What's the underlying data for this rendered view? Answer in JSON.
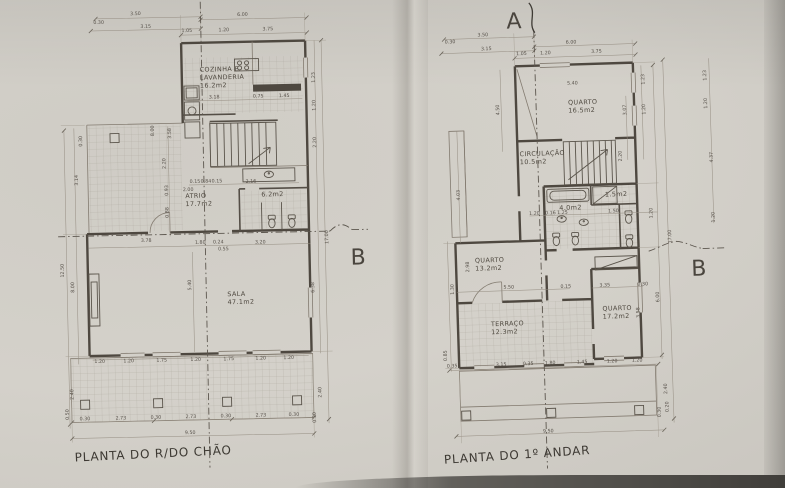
{
  "markers": {
    "a": "A",
    "b_left": "B",
    "b_right": "B"
  },
  "plans": {
    "ground": {
      "caption": "PLANTA DO R/DO CHÃO",
      "rooms": [
        {
          "name": "COZINHA  E\nLAVANDERIA",
          "area": "16.2m2",
          "x": 203,
          "y": 72
        },
        {
          "name": "ATRIO",
          "area": "17.7m2",
          "x": 186,
          "y": 198
        },
        {
          "name": "",
          "area": "6.2m2",
          "x": 262,
          "y": 198
        },
        {
          "name": "SALA",
          "area": "47.1m2",
          "x": 226,
          "y": 297
        }
      ],
      "dims": [
        {
          "t": "3.50",
          "x": 140,
          "y": 14
        },
        {
          "t": "0.30",
          "x": 103,
          "y": 22
        },
        {
          "t": "3.15",
          "x": 150,
          "y": 27
        },
        {
          "t": "6.00",
          "x": 247,
          "y": 17
        },
        {
          "t": "1.05",
          "x": 191,
          "y": 32
        },
        {
          "t": "1.20",
          "x": 228,
          "y": 32
        },
        {
          "t": "3.75",
          "x": 272,
          "y": 32
        },
        {
          "t": "1.23",
          "x": 318,
          "y": 80,
          "r": -90
        },
        {
          "t": "1.20",
          "x": 318,
          "y": 108,
          "r": -90
        },
        {
          "t": "2.20",
          "x": 318,
          "y": 145,
          "r": -90
        },
        {
          "t": "17.00",
          "x": 328,
          "y": 240,
          "r": -90
        },
        {
          "t": "6.38",
          "x": 313,
          "y": 290,
          "r": -90
        },
        {
          "t": "2.40",
          "x": 318,
          "y": 395,
          "r": -90
        },
        {
          "t": "0.30",
          "x": 312,
          "y": 420,
          "r": -90
        },
        {
          "t": "3.18",
          "x": 217,
          "y": 99
        },
        {
          "t": "0.75",
          "x": 261,
          "y": 99
        },
        {
          "t": "1.45",
          "x": 287,
          "y": 99
        },
        {
          "t": "8.00",
          "x": 156,
          "y": 130,
          "r": -90
        },
        {
          "t": "3.58",
          "x": 173,
          "y": 133,
          "r": -90
        },
        {
          "t": "2.20",
          "x": 167,
          "y": 163,
          "r": -90
        },
        {
          "t": "0.93",
          "x": 169,
          "y": 190,
          "r": -90
        },
        {
          "t": "0.88",
          "x": 169,
          "y": 212,
          "r": -90
        },
        {
          "t": "0.30",
          "x": 84,
          "y": 139,
          "r": -90
        },
        {
          "t": "3.14",
          "x": 79,
          "y": 178,
          "r": -90
        },
        {
          "t": "12.50",
          "x": 63,
          "y": 268,
          "r": -90
        },
        {
          "t": "8.00",
          "x": 73,
          "y": 285,
          "r": -90
        },
        {
          "t": "2.40",
          "x": 70,
          "y": 392,
          "r": -90
        },
        {
          "t": "0.50",
          "x": 65,
          "y": 412,
          "r": -90
        },
        {
          "t": "0.15",
          "x": 196,
          "y": 183
        },
        {
          "t": "0.84",
          "x": 207,
          "y": 183
        },
        {
          "t": "0.15",
          "x": 218,
          "y": 183
        },
        {
          "t": "2.16",
          "x": 252,
          "y": 184
        },
        {
          "t": "2.00",
          "x": 189,
          "y": 191
        },
        {
          "t": "3.78",
          "x": 146,
          "y": 241
        },
        {
          "t": "1.80",
          "x": 200,
          "y": 244
        },
        {
          "t": "0.24",
          "x": 218,
          "y": 244
        },
        {
          "t": "0.55",
          "x": 223,
          "y": 251
        },
        {
          "t": "3.20",
          "x": 260,
          "y": 245
        },
        {
          "t": "5.40",
          "x": 190,
          "y": 285,
          "r": -90
        },
        {
          "t": "1.20",
          "x": 97,
          "y": 361
        },
        {
          "t": "1.20",
          "x": 126,
          "y": 361
        },
        {
          "t": "1.75",
          "x": 159,
          "y": 361
        },
        {
          "t": "1.20",
          "x": 193,
          "y": 361
        },
        {
          "t": "1.75",
          "x": 226,
          "y": 361
        },
        {
          "t": "1.20",
          "x": 258,
          "y": 361
        },
        {
          "t": "1.20",
          "x": 286,
          "y": 361
        },
        {
          "t": "0.30",
          "x": 81,
          "y": 418
        },
        {
          "t": "2.73",
          "x": 117,
          "y": 418
        },
        {
          "t": "0.30",
          "x": 152,
          "y": 418
        },
        {
          "t": "2.73",
          "x": 187,
          "y": 418
        },
        {
          "t": "0.30",
          "x": 222,
          "y": 418
        },
        {
          "t": "2.73",
          "x": 257,
          "y": 418
        },
        {
          "t": "0.30",
          "x": 290,
          "y": 418
        },
        {
          "t": "9.50",
          "x": 186,
          "y": 434
        }
      ]
    },
    "first": {
      "caption": "PLANTA DO 1º ANDAR",
      "rooms": [
        {
          "name": "QUARTO",
          "area": "16.5m2",
          "x": 572,
          "y": 105
        },
        {
          "name": "CIRCULAÇÃO",
          "area": "10.5m2",
          "x": 522,
          "y": 155
        },
        {
          "name": "",
          "area": "4.0m2",
          "x": 560,
          "y": 210
        },
        {
          "name": "",
          "area": "1.5m2",
          "x": 606,
          "y": 198
        },
        {
          "name": "QUARTO",
          "area": "13.2m2",
          "x": 474,
          "y": 260
        },
        {
          "name": "TERRAÇO",
          "area": "12.3m2",
          "x": 488,
          "y": 324
        },
        {
          "name": "QUARTO",
          "area": "17.2m2",
          "x": 600,
          "y": 312
        }
      ],
      "dims": [
        {
          "t": "3.50",
          "x": 489,
          "y": 34
        },
        {
          "t": "0.30",
          "x": 456,
          "y": 40
        },
        {
          "t": "3.15",
          "x": 492,
          "y": 48
        },
        {
          "t": "6.00",
          "x": 577,
          "y": 44
        },
        {
          "t": "1.05",
          "x": 527,
          "y": 54
        },
        {
          "t": "1.20",
          "x": 551,
          "y": 54
        },
        {
          "t": "3.75",
          "x": 602,
          "y": 54
        },
        {
          "t": "5.40",
          "x": 577,
          "y": 85
        },
        {
          "t": "4.50",
          "x": 503,
          "y": 108,
          "r": -90
        },
        {
          "t": "1.23",
          "x": 649,
          "y": 82,
          "r": -90
        },
        {
          "t": "3.07",
          "x": 630,
          "y": 112,
          "r": -90
        },
        {
          "t": "1.20",
          "x": 649,
          "y": 112,
          "r": -90
        },
        {
          "t": "1.23",
          "x": 711,
          "y": 80,
          "r": -90
        },
        {
          "t": "1.20",
          "x": 711,
          "y": 108,
          "r": -90
        },
        {
          "t": "4.37",
          "x": 715,
          "y": 162,
          "r": -90
        },
        {
          "t": "1.20",
          "x": 715,
          "y": 222,
          "r": -90
        },
        {
          "t": "17.00",
          "x": 671,
          "y": 240,
          "r": -90
        },
        {
          "t": "2.20",
          "x": 624,
          "y": 158,
          "r": -90
        },
        {
          "t": "1.20",
          "x": 535,
          "y": 214
        },
        {
          "t": "0.16",
          "x": 551,
          "y": 214
        },
        {
          "t": "1.25",
          "x": 563,
          "y": 214
        },
        {
          "t": "1.50",
          "x": 614,
          "y": 214
        },
        {
          "t": "1.20",
          "x": 653,
          "y": 216,
          "r": -90
        },
        {
          "t": "2.98",
          "x": 468,
          "y": 264,
          "r": -90
        },
        {
          "t": "1.30",
          "x": 452,
          "y": 286,
          "r": -90
        },
        {
          "t": "5.50",
          "x": 507,
          "y": 287
        },
        {
          "t": "0.15",
          "x": 564,
          "y": 288
        },
        {
          "t": "3.35",
          "x": 603,
          "y": 288
        },
        {
          "t": "0.30",
          "x": 641,
          "y": 288
        },
        {
          "t": "6.00",
          "x": 657,
          "y": 300,
          "r": -90
        },
        {
          "t": "3.58",
          "x": 637,
          "y": 315,
          "r": -90
        },
        {
          "t": "4.03",
          "x": 461,
          "y": 192,
          "r": -90
        },
        {
          "t": "0.85",
          "x": 443,
          "y": 352,
          "r": -90
        },
        {
          "t": "0.35",
          "x": 448,
          "y": 364
        },
        {
          "t": "3.15",
          "x": 497,
          "y": 364
        },
        {
          "t": "0.35",
          "x": 524,
          "y": 364
        },
        {
          "t": "1.80",
          "x": 546,
          "y": 364
        },
        {
          "t": "1.45",
          "x": 578,
          "y": 364
        },
        {
          "t": "1.20",
          "x": 608,
          "y": 364
        },
        {
          "t": "1.20",
          "x": 633,
          "y": 364
        },
        {
          "t": "9.50",
          "x": 542,
          "y": 432
        },
        {
          "t": "2.40",
          "x": 662,
          "y": 392,
          "r": -90
        },
        {
          "t": "0.30",
          "x": 655,
          "y": 415,
          "r": -90
        },
        {
          "t": "0.20",
          "x": 663,
          "y": 410,
          "r": -90
        }
      ]
    }
  }
}
